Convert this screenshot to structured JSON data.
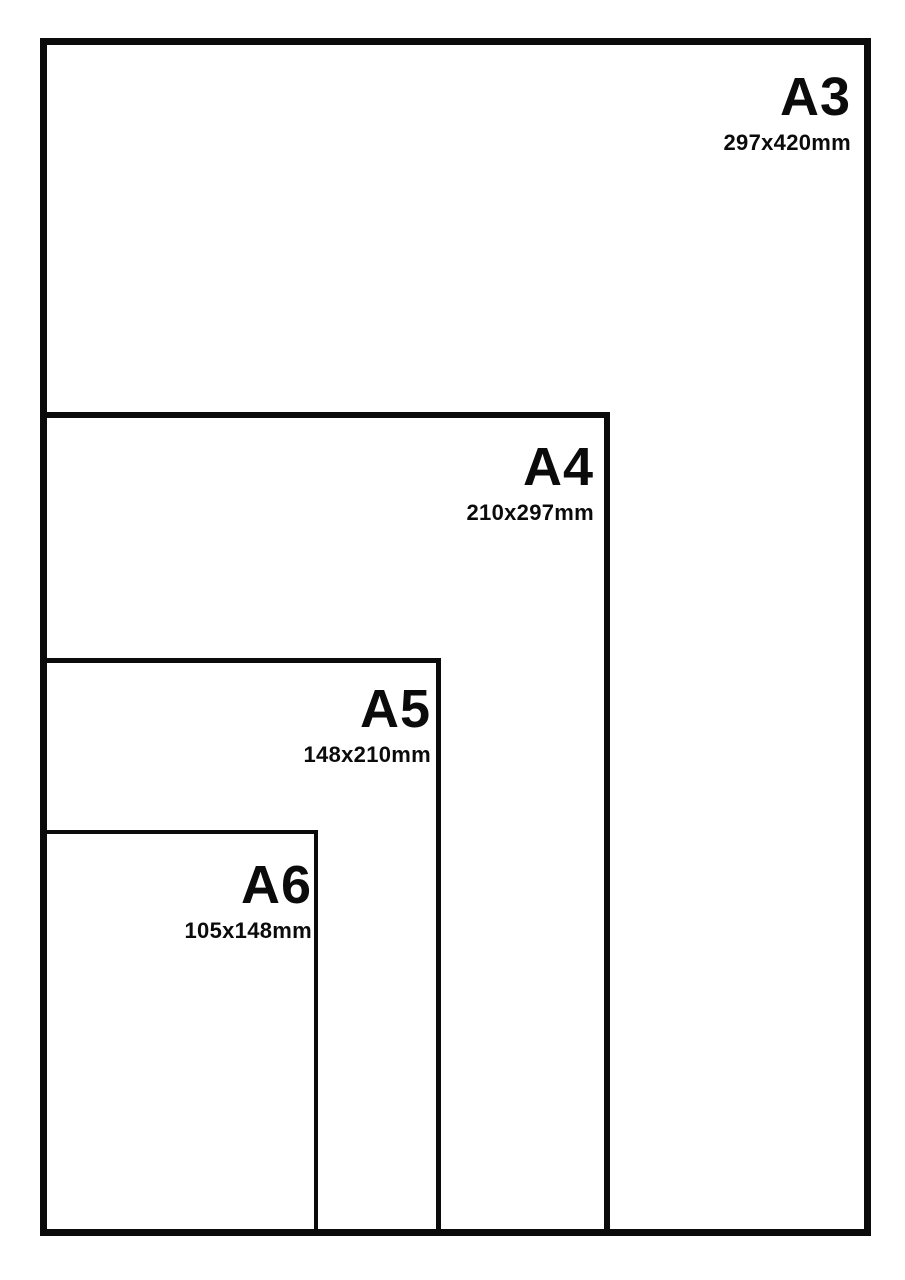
{
  "diagram": {
    "sizes": [
      {
        "label": "A3",
        "dimensions": "297x420mm"
      },
      {
        "label": "A4",
        "dimensions": "210x297mm"
      },
      {
        "label": "A5",
        "dimensions": "148x210mm"
      },
      {
        "label": "A6",
        "dimensions": "105x148mm"
      }
    ],
    "colors": {
      "line": "#0b0b0b",
      "background": "#ffffff",
      "text": "#0b0b0b"
    }
  }
}
